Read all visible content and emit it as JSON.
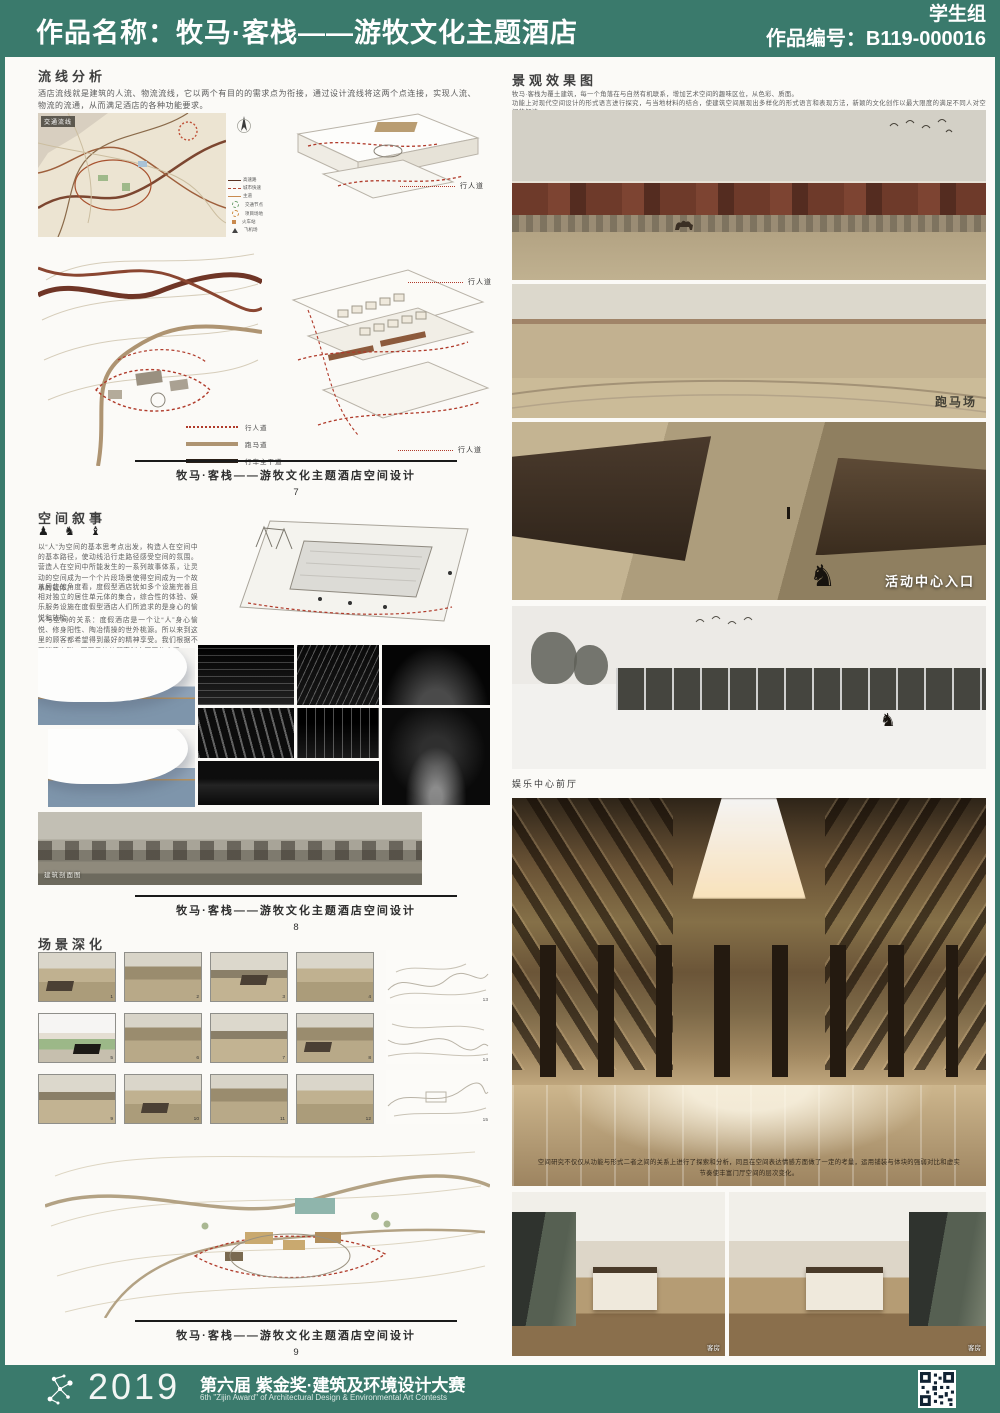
{
  "header": {
    "title": "作品名称：牧马·客栈——游牧文化主题酒店",
    "group": "学生组",
    "number": "作品编号：B119-000016"
  },
  "left": {
    "flow": {
      "heading": "流线分析",
      "body": "酒店流线就是建筑的人流、物流流线，它以两个有目的的需求点为衔接，通过设计流线将这两个点连接，实现人流、物流的流通，从而满足酒店的各种功能要求。",
      "map_label": "交通流线",
      "map_legend": [
        "高速路",
        "城市快速",
        "主道",
        "交通节点",
        "项目场地",
        "火车站",
        "飞机场"
      ],
      "axon_label_1": "行人道",
      "axon_label_2": "行人道",
      "axon_label_3": "行人道",
      "plan_legend": [
        "行人道",
        "跑马道",
        "行车主干道"
      ],
      "caption": "牧马·客栈——游牧文化主题酒店空间设计",
      "page": "7"
    },
    "narrative": {
      "heading": "空间叙事",
      "icons": "♟ ♞ ♝",
      "p1": "以“人”为空间的基本思考点出发，构造人在空间中的基本路径，使动线沿行走路径感受空间的氛围。营造人在空间中所能发生的一系列故事体系，让灵动的空间成为一个个片段场景使得空间成为一个故事的载体。",
      "p2": "从居住的角度看，度假型酒店犹如多个设施完善且相对独立的居住单元体的集合，综合性的体验、娱乐服务设施在度假型酒店人们所追求的是身心的愉悦和放松。",
      "p3": "人与空间的关系：度假酒店是一个让“人”身心愉悦、修身阳性、陶冶情操的世外桃源。所以来到这里的顾客都希望得到最好的精神享受。我们根据不同消费人群、不同目的的顾客制定不同的空间。",
      "section_label": "建筑剖面图",
      "caption": "牧马·客栈——游牧文化主题酒店空间设计",
      "page": "8"
    },
    "scenes": {
      "heading": "场景深化",
      "numbers": [
        "1",
        "2",
        "3",
        "4",
        "5",
        "6",
        "7",
        "8",
        "9",
        "10",
        "11",
        "12"
      ],
      "sketch_numbers": [
        "13",
        "14",
        "15"
      ],
      "caption": "牧马·客栈——游牧文化主题酒店空间设计",
      "page": "9"
    }
  },
  "right": {
    "heading": "景观效果图",
    "line1": "牧马·客栈为覆土建筑，每一个角落在与自然有机联系，增加艺术空间的趣味区位，从色彩、质面。",
    "line2": "功能上对现代空间设计的形式语言进行探究，与当地材料的结合，使建筑空间展现出多样化的形式语言和表现方法，新颖的文化创作以最大限度的满足不同人对空间的解读。",
    "label_racecourse": "跑马场",
    "label_activity": "活动中心入口",
    "label_front_hall": "娱乐中心前厅",
    "lobby_note": "空间研究不仅仅从功能与形式二者之间的关系上进行了探索和分析，同且在空间表达情感方面做了一定的考量，运用铺装与体块的强弱对比和虚实节奏使丰富门厅空间的层次变化。",
    "room_label_1": "客房",
    "room_label_2": "客房"
  },
  "footer": {
    "year": "2019",
    "title": "第六届 紫金奖·建筑及环境设计大赛",
    "subtitle": "6th \"Zijin Award\" of Architectural Design & Environmental Art Contests"
  },
  "colors": {
    "teal": "#3a7a6c",
    "accent_red": "#b03a2a"
  }
}
